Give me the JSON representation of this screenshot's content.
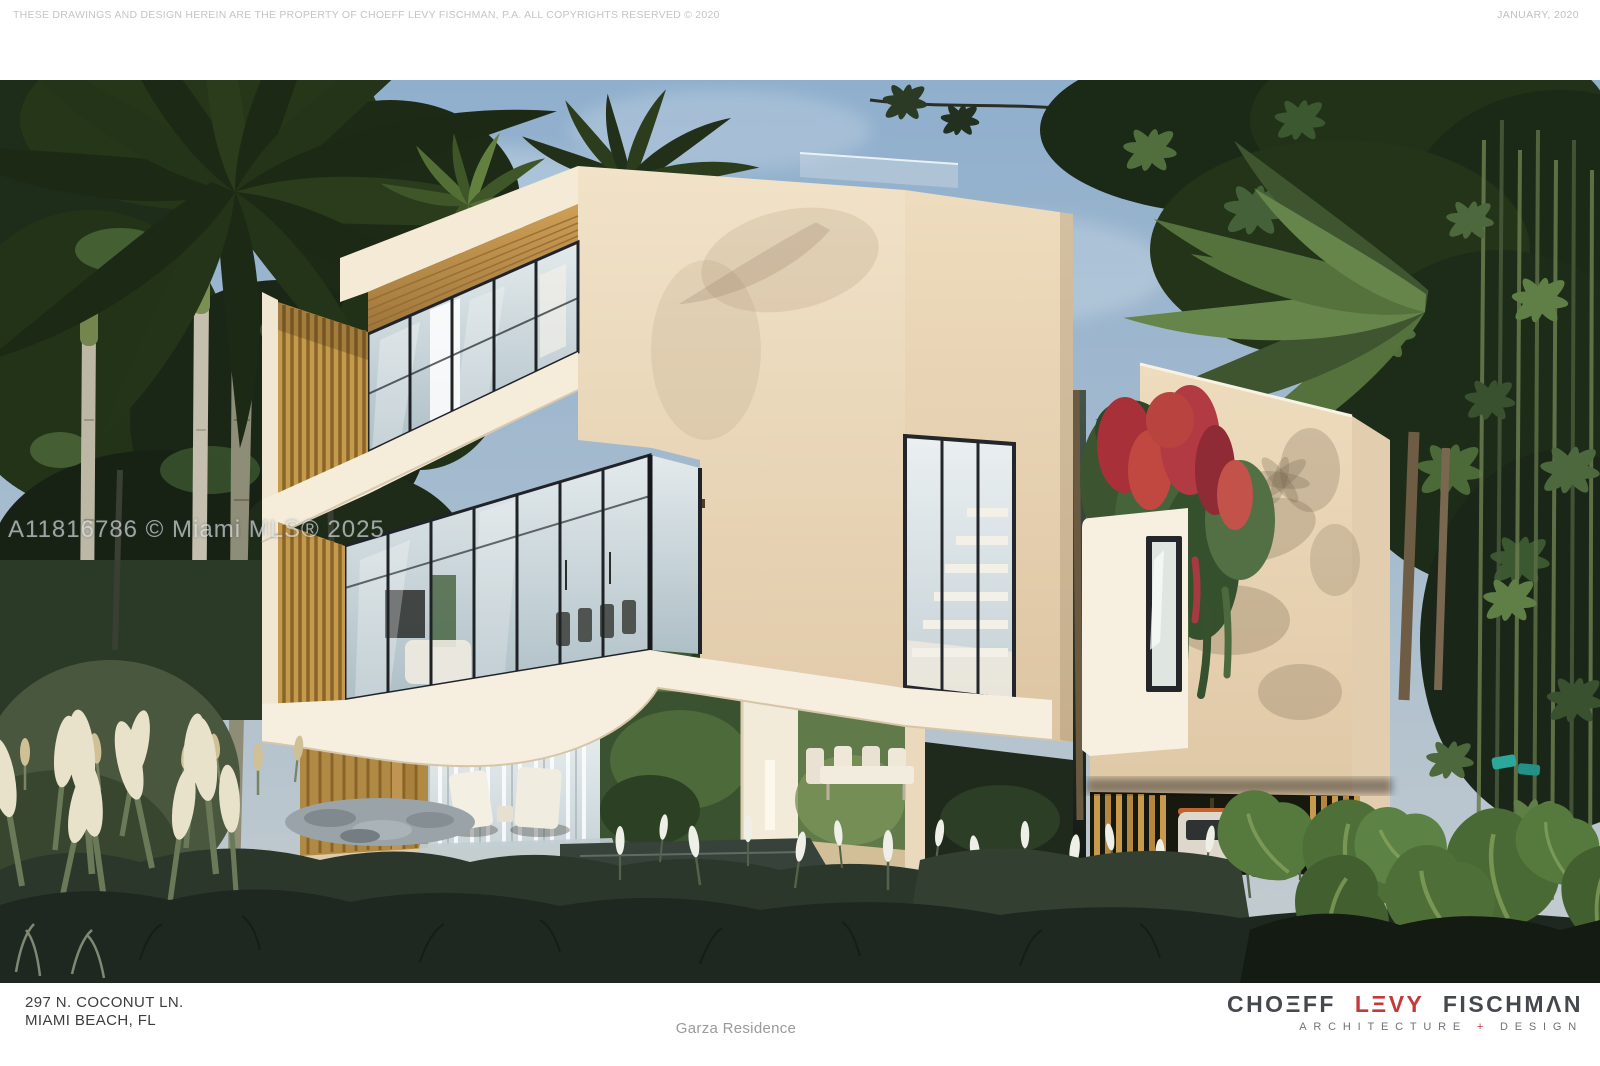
{
  "header": {
    "disclaimer": "THESE DRAWINGS AND DESIGN HEREIN ARE THE PROPERTY OF CHOEFF LEVY FISCHMAN, P.A. ALL COPYRIGHTS RESERVED © 2020",
    "date": "JANUARY, 2020"
  },
  "render": {
    "watermark": "A11816786 © Miami MLS® 2025"
  },
  "footer": {
    "address_line1": "297 N. COCONUT LN.",
    "address_line2": "MIAMI BEACH, FL",
    "project_title": "Garza Residence",
    "logo": {
      "word1": "CHOΞFF",
      "word2": "LΞVY",
      "word3": "FISCHMΛN",
      "tagline_word1": "ARCHITECTURE",
      "tagline_plus": "+",
      "tagline_word2": "DESIGN"
    }
  },
  "colors": {
    "logo_text": "#45494e",
    "logo_accent": "#c23a3c",
    "header_text": "#c5c5c5",
    "address_text": "#3d3d3d",
    "title_text": "#9a9a9a",
    "watermark_text": "rgba(238,242,244,0.62)",
    "sky": "#9db9d2",
    "stucco_cream": "#f0e2c8",
    "wood_accent": "#c79a52",
    "glass": "#cfd9dd",
    "foliage_dark": "#223420",
    "red_car": "#c0231c",
    "bougainvillea": "#b23a42"
  }
}
